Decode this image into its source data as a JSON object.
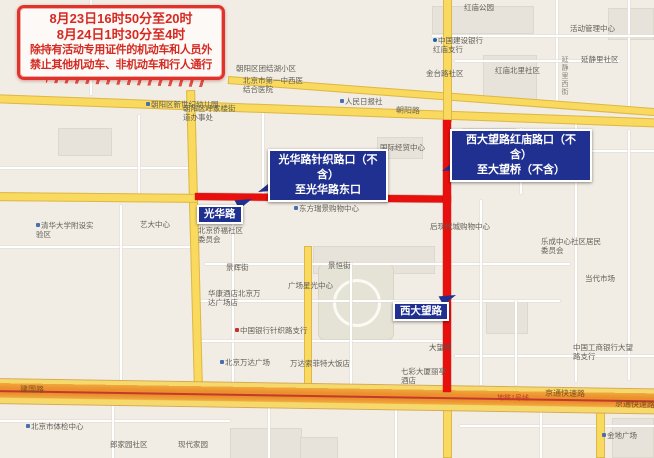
{
  "notice": {
    "line1": "8月23日16时50分至20时",
    "line2": "8月24日1时30分至4时",
    "line3": "除持有活动专用证件的机动车和人员外",
    "line4": "禁止其他机动车、非机动车和行人通行"
  },
  "callouts": {
    "guanghua": {
      "line1": "光华路针织路口（不含）",
      "line2": "至光华路东口"
    },
    "xidawang": {
      "line1": "西大望路红庙路口（不含）",
      "line2": "至大望桥（不含）"
    }
  },
  "road_badges": {
    "guanghua": "光华路",
    "xidawang": "西大望路"
  },
  "road_labels": {
    "chaoyang": "朝阳路",
    "jianguo": "建国路",
    "jingtong_1": "京通快速路",
    "jingtong_2": "京通快速路",
    "metro_line1": "地铁1号线",
    "dawang_bridge": "大望桥",
    "yanjing_west_st": "延静里西街"
  },
  "colors": {
    "restricted_red": "#e8100c",
    "callout_blue": "#203090",
    "road_yellow": "#fada5e",
    "highway_orange": "#ec8f2c",
    "notice_red": "#d42a22"
  },
  "pois": [
    {
      "t": "红庙公园",
      "x": 464,
      "y": 3
    },
    {
      "t": "活动管理中心",
      "x": 570,
      "y": 24
    },
    {
      "t": "延静里社区",
      "x": 581,
      "y": 55
    },
    {
      "t": "中国建设银行红庙支行",
      "x": 433,
      "y": 36,
      "w": 54,
      "ic": "bank-blue"
    },
    {
      "t": "金台路社区",
      "x": 426,
      "y": 69
    },
    {
      "t": "红庙北里社区",
      "x": 495,
      "y": 66
    },
    {
      "t": "朝阳区团结湖小区",
      "x": 236,
      "y": 64
    },
    {
      "t": "北京市第一中西医结合医院",
      "x": 243,
      "y": 76,
      "w": 62
    },
    {
      "t": "朝阳区新世纪幼儿园",
      "x": 146,
      "y": 100,
      "ic": "dot"
    },
    {
      "t": "人民日报社",
      "x": 340,
      "y": 97,
      "ic": "dot"
    },
    {
      "t": "朝阳区呼家楼街道办事处",
      "x": 183,
      "y": 104,
      "w": 56
    },
    {
      "t": "国际经贸中心",
      "x": 380,
      "y": 143
    },
    {
      "t": "东方瑞景购物中心",
      "x": 294,
      "y": 204,
      "ic": "dot"
    },
    {
      "t": "清华大学附设实验区",
      "x": 36,
      "y": 221,
      "w": 58,
      "ic": "dot"
    },
    {
      "t": "艺大中心",
      "x": 140,
      "y": 220
    },
    {
      "t": "北京侨福社区委员会",
      "x": 198,
      "y": 226,
      "w": 52
    },
    {
      "t": "后现代城购物中心",
      "x": 430,
      "y": 222
    },
    {
      "t": "乐成中心社区居民委员会",
      "x": 541,
      "y": 237,
      "w": 62
    },
    {
      "t": "当代市场",
      "x": 585,
      "y": 274
    },
    {
      "t": "景辉街",
      "x": 226,
      "y": 263
    },
    {
      "t": "景恒街",
      "x": 328,
      "y": 261
    },
    {
      "t": "华康酒店北京万达广场店",
      "x": 208,
      "y": 289,
      "w": 58
    },
    {
      "t": "广场星光中心",
      "x": 288,
      "y": 281
    },
    {
      "t": "中国银行针织路支行",
      "x": 235,
      "y": 326,
      "ic": "bank-red"
    },
    {
      "t": "北京万达广场",
      "x": 220,
      "y": 358,
      "ic": "dot"
    },
    {
      "t": "万达索菲特大饭店",
      "x": 290,
      "y": 359
    },
    {
      "t": "七彩大厦丽亭酒店",
      "x": 401,
      "y": 367,
      "w": 50
    },
    {
      "t": "中国工商银行大望路支行",
      "x": 573,
      "y": 343,
      "w": 60
    },
    {
      "t": "北京市体检中心",
      "x": 26,
      "y": 422,
      "ic": "dot"
    },
    {
      "t": "郎家园社区",
      "x": 110,
      "y": 440
    },
    {
      "t": "现代家园",
      "x": 178,
      "y": 440
    },
    {
      "t": "金地广场",
      "x": 602,
      "y": 431,
      "ic": "dot"
    }
  ]
}
